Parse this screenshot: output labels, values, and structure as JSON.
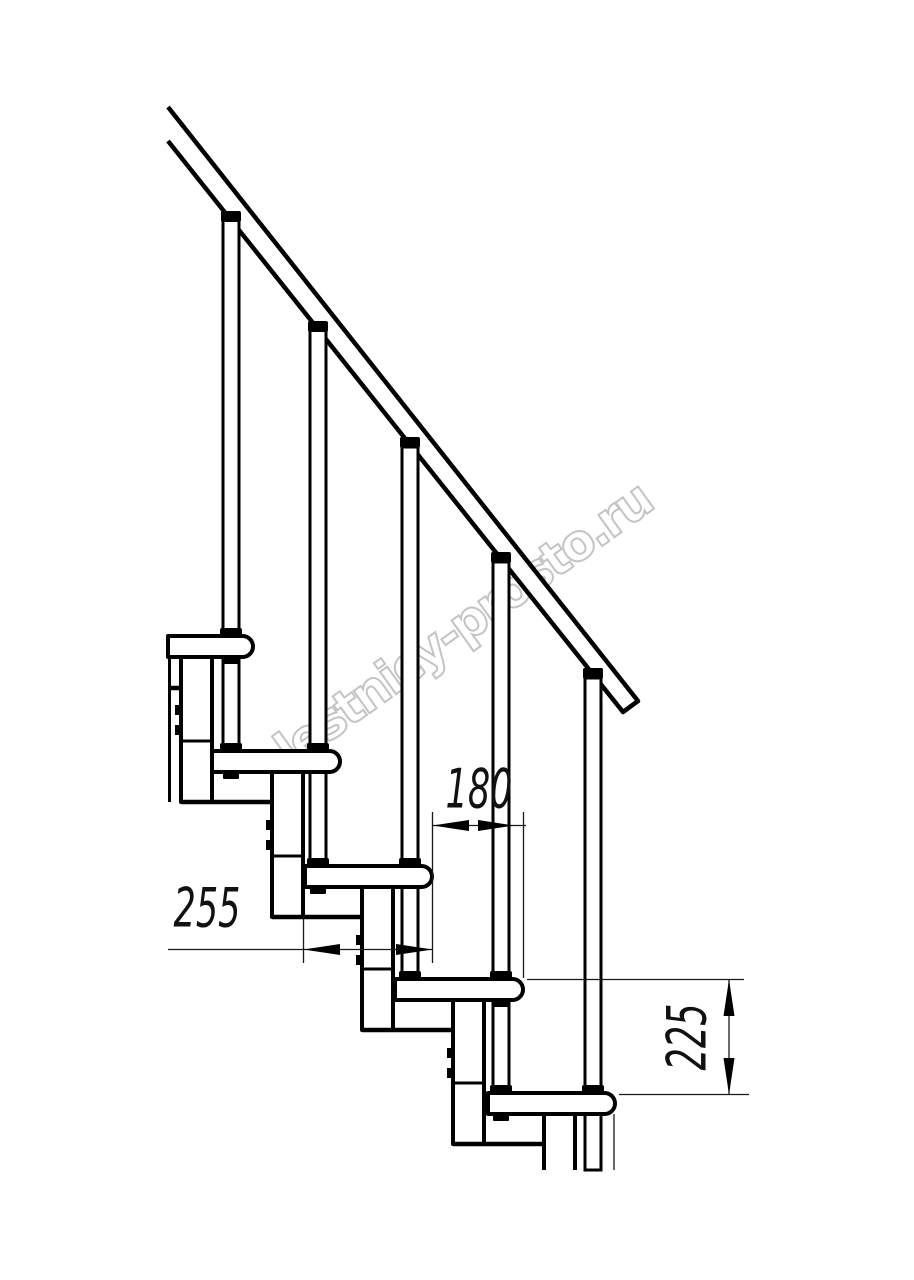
{
  "watermark": "lestnicy-prosto.ru",
  "dimensions": {
    "run": "180",
    "depth": "255",
    "rise": "225"
  }
}
